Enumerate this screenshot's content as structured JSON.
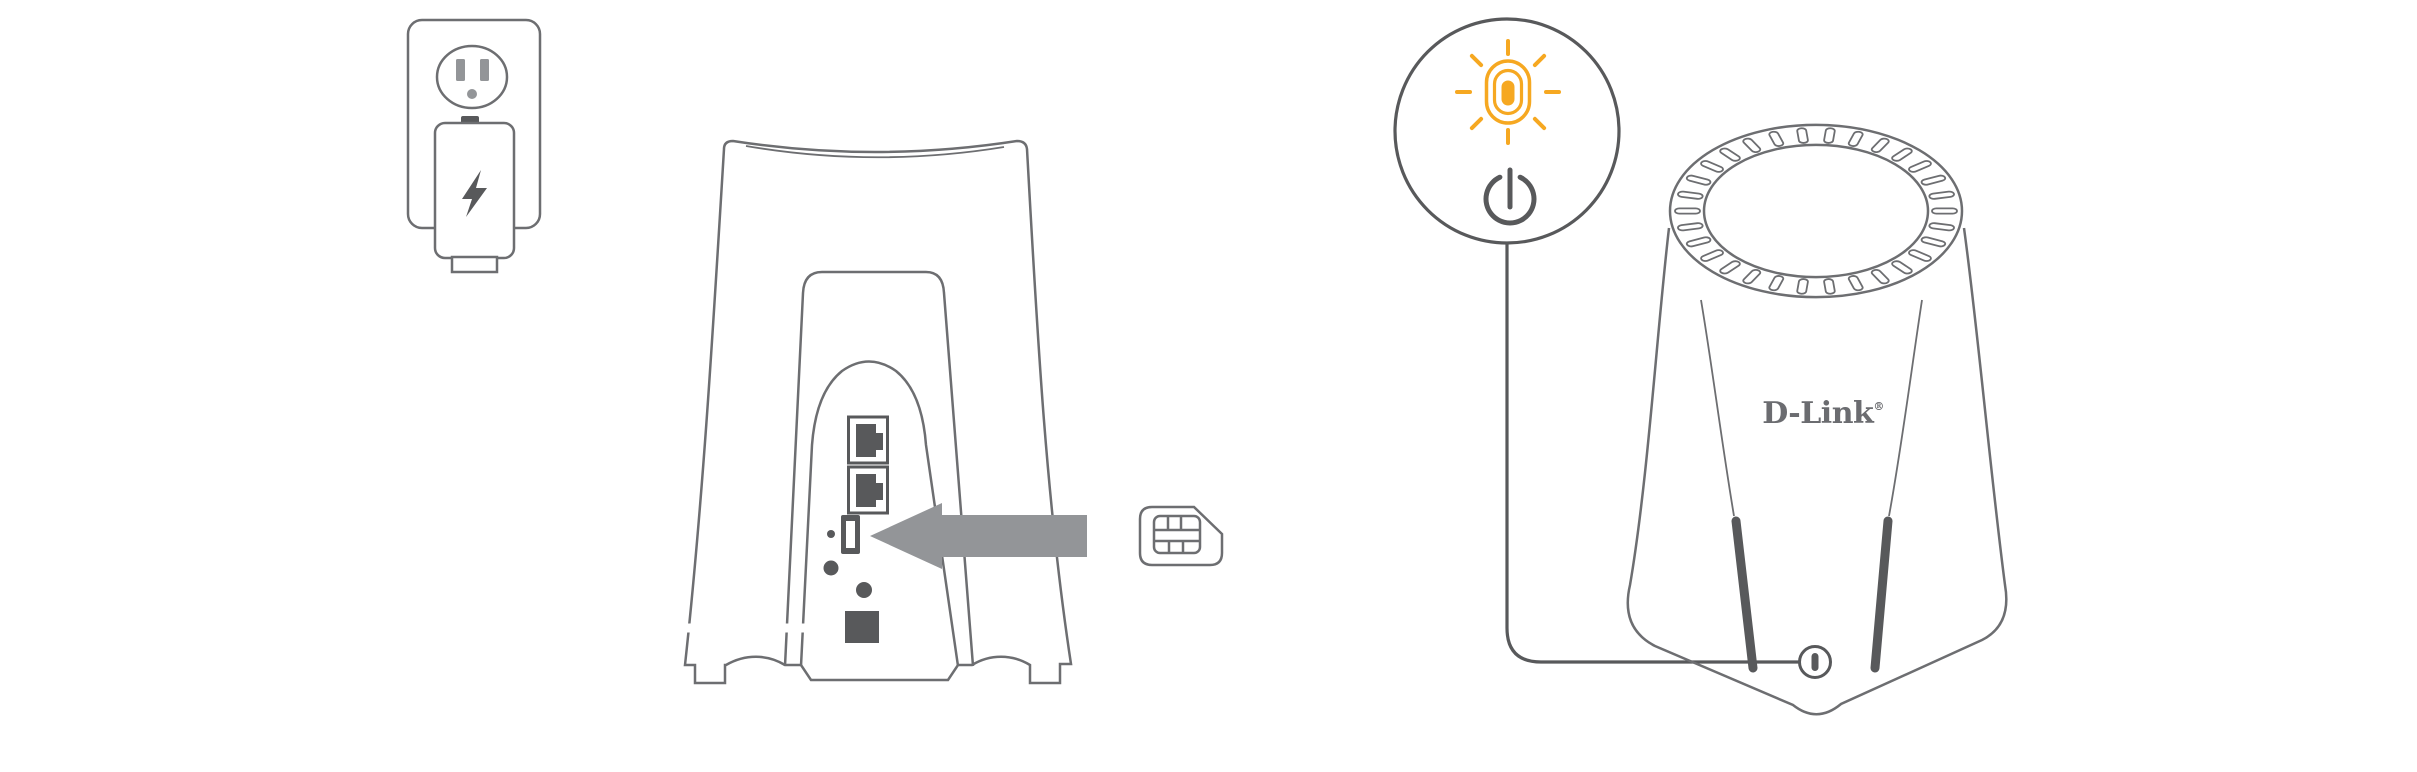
{
  "colors": {
    "background": "#FFFFFF",
    "outline_gray": "#6D6E71",
    "dark_gray": "#58595B",
    "fill_gray": "#939598",
    "accent_orange": "#F6A821",
    "logo_gray": "#6B6C70"
  },
  "logo": {
    "text": "D-Link",
    "registered_mark": "®"
  },
  "icons": {
    "power_adapter_badge": "lightning-bolt",
    "sim_insert_direction": "left-arrow",
    "sim_card": "sim-card",
    "status_led": "glowing-led-pill",
    "power_button": "power-symbol"
  }
}
